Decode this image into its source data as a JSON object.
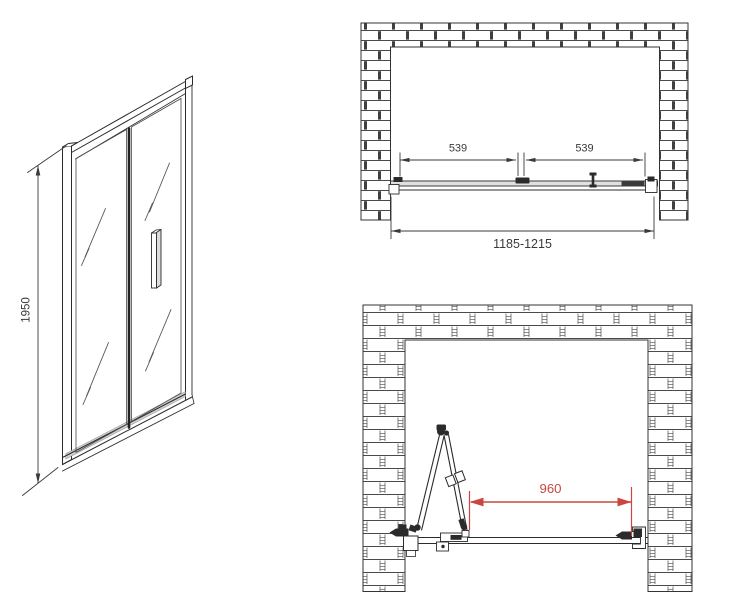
{
  "colors": {
    "line": "#2b2b2b",
    "dimension_text": "#3a3a3a",
    "dimension_red": "#c9473f",
    "glass": "#ffffff",
    "threshold_gray": "#cfcfcf"
  },
  "front_view": {
    "height_label": "1950"
  },
  "top_view_closed": {
    "left_panel_label": "539",
    "right_panel_label": "539",
    "overall_label": "1185-1215"
  },
  "top_view_open": {
    "opening_label": "960"
  }
}
